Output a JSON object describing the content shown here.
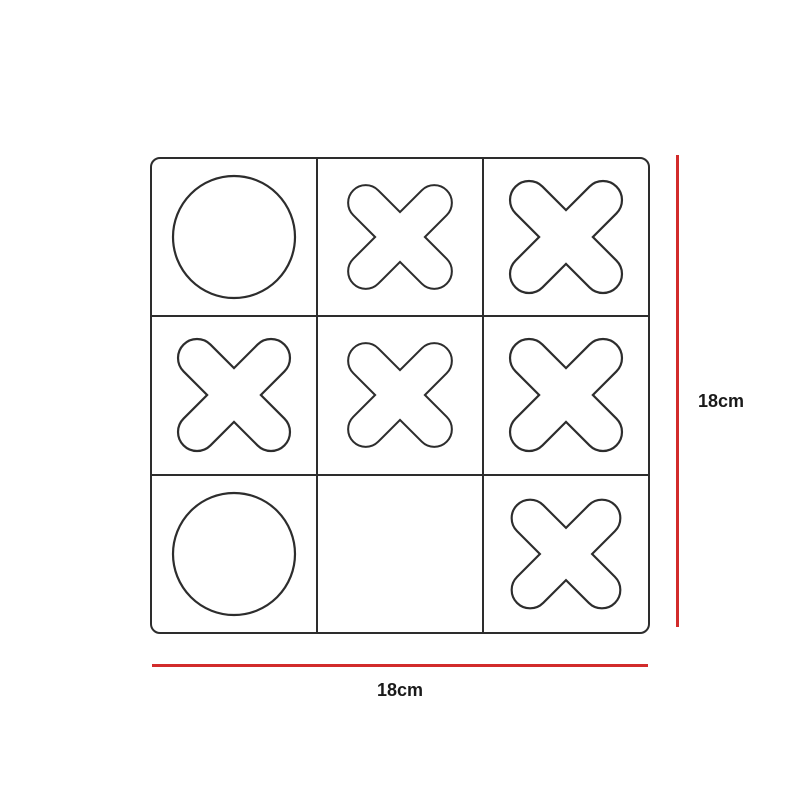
{
  "diagram": {
    "type": "product-dimension-diagram",
    "subject": "tic-tac-toe-board"
  },
  "board": {
    "rows": 3,
    "cols": 3,
    "cells": [
      [
        "O",
        "X",
        "X"
      ],
      [
        "X",
        "X",
        "X"
      ],
      [
        "O",
        "",
        "X"
      ]
    ],
    "marks": {
      "O": "circle-outline",
      "X": "rounded-cross-outline"
    }
  },
  "dimensions": {
    "height": {
      "label": "18cm",
      "side": "right"
    },
    "width": {
      "label": "18cm",
      "side": "bottom"
    }
  },
  "colors": {
    "outline": "#2d2d2d",
    "dimension_line": "#d22b2b",
    "label_text": "#1a1a1a",
    "background": "#ffffff"
  }
}
